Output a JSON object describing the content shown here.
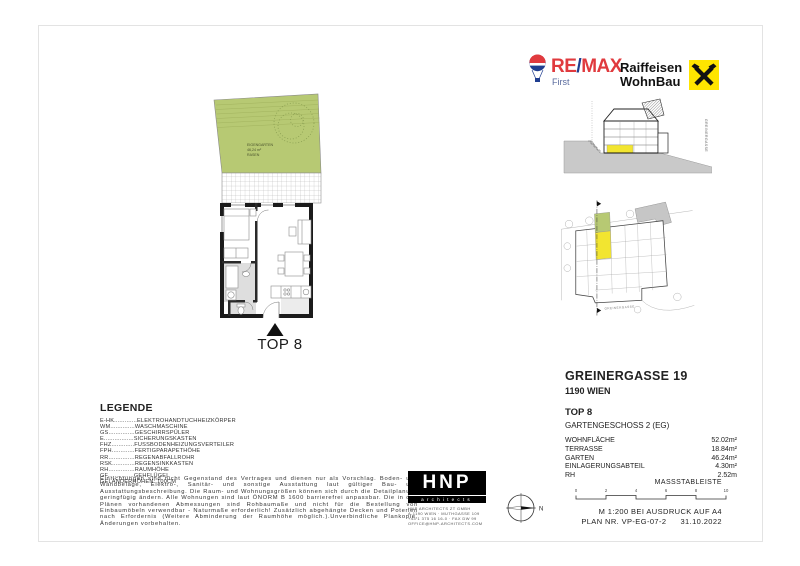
{
  "logos": {
    "remax": {
      "brand_re": "RE",
      "brand_slash": "/",
      "brand_max": "MAX",
      "sub": "First"
    },
    "raiffeisen": {
      "line1": "Raiffeisen",
      "line2": "WohnBau"
    }
  },
  "floorplan": {
    "garden_line1": "EIGENGARTEN",
    "garden_line2": "46,24 m²",
    "garden_line3": "RASEN",
    "unit_label": "TOP 8"
  },
  "section_diagram": {
    "street_right": "GREINERGASSE"
  },
  "site_plan": {
    "street_label": "GREINERGASSE"
  },
  "info": {
    "address": "GREINERGASSE 19",
    "city": "1190 WIEN",
    "unit": "TOP  8",
    "floor": "GARTENGESCHOSS 2 (EG)",
    "rows": [
      {
        "label": "WOHNFLÄCHE",
        "value": "52.02m²"
      },
      {
        "label": "TERRASSE",
        "value": "18.84m²"
      },
      {
        "label": "GARTEN",
        "value": "46.24m²"
      },
      {
        "label": "EINLAGERUNGSABTEIL",
        "value": "4.30m²"
      },
      {
        "label": "RH",
        "value": "2.52m"
      }
    ]
  },
  "legend": {
    "title": "LEGENDE",
    "items": [
      "E-HK.............ELEKTROHANDTUCHHEIZKÖRPER",
      "WM..............WASCHMASCHINE",
      "GS...............GESCHIRRSPÜLER",
      "E.................SICHERUNGSKASTEN",
      "FHZ.............FUSSBODENHEIZUNGSVERTEILER",
      "FPH.............FERTIGPARAPETHÖHE",
      "RR...............REGENABFALLROHR",
      "RSK.............REGENSINKKASTEN",
      "RH...............RAUMHÖHE",
      "GF...............GEHFLÜGEL",
      "GELÄNDERHÖHEN: 100CM"
    ]
  },
  "disclaimer": "Einrichtungen sind nicht Gegenstand des Vertrages und dienen nur als Vorschlag. Boden- und Wandbeläge, Elektro-, Sanitär- und sonstige Ausstattung laut gültiger Bau- und Ausstattungsbeschreibung. Die Raum- und Wohnungsgrößen können sich durch die Detailplanung geringfügig ändern. Alle Wohnungen sind laut ÖNORM B 1600 barrierefrei anpassbar. Die in den Plänen vorhandenen Abmessungen sind Rohbaumaße und nicht für die Bestellung von Einbaumöbeln verwendbar - Naturmaße erforderlich! Zusätzlich abgehängte Decken und Poterien nach Erfordernis (Weitere Abminderung der Raumhöhe möglich.).Unverbindliche Plankopie, Änderungen vorbehalten.",
  "architect": {
    "logo_text": "HNP",
    "logo_sub": "architects",
    "lines": [
      "HNP ARCHITECTS ZT GMBH",
      "A-1190 WIEN · MUTHGASSE 109",
      "+43 1 375 16 16-0 · FAX DW 99",
      "OFFICE@HNP-ARCHITECTS.COM"
    ]
  },
  "compass": {
    "label": "N"
  },
  "scalebar": {
    "title": "MASSSTABLEISTE",
    "ticks": [
      "0",
      "2",
      "4",
      "6",
      "8",
      "10"
    ]
  },
  "plan_meta": {
    "scale_note": "M 1:200 BEI AUSDRUCK AUF A4",
    "plan_no": "PLAN NR. VP-EG-07-2",
    "date": "31.10.2022"
  },
  "colors": {
    "garden_green": "#b7c973",
    "highlight_yellow": "#f2e530",
    "terrain_gray": "#c9c9c9",
    "remax_red": "#e03a3e",
    "remax_blue": "#1f3e90",
    "raiffeisen_yellow": "#ffe500"
  }
}
